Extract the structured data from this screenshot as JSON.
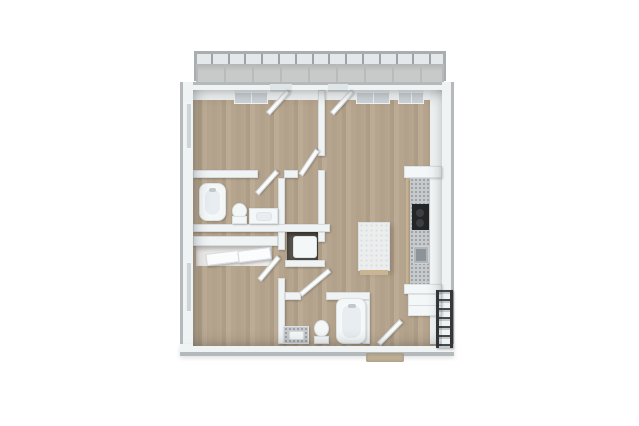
{
  "scene": {
    "type": "3d-floor-plan-render",
    "view": "top-down",
    "unit": "two-bedroom-two-bath-apartment-with-balcony",
    "visible_text": ""
  },
  "palette": {
    "bg": "#ffffff",
    "wood_a": "#b6a58e",
    "wood_b": "#ae9d86",
    "wood_c": "#bdac95",
    "wood_d": "#b3a28b",
    "balcony_tile": "#c7cac9",
    "balcony_grout": "#b7bbba",
    "railing_glass": "rgba(206,214,217,0.55)",
    "rail_bar": "#a9aeb1",
    "post": "#9da3a6",
    "wall_face": "#f0f3f4",
    "wall_edge": "#b4b9bc",
    "glass": "#cdd4d8",
    "leaf_white": "#fbfcfd",
    "fixture_white": "#f4f7f8",
    "fixture_inner": "#e7edf0",
    "granite": "#c6cacc",
    "granite_dot": "#9aa0a3",
    "wood_cabinet": "#c6b294",
    "appliance_black": "#232527",
    "burner": "#3c3f42",
    "sink_outer": "#b0b6ba",
    "sink_inner": "#8d9498",
    "rack_dark": "#35383b",
    "rack_rung": "#45494c",
    "island_top": "#eceeee",
    "island_dot": "#d9dddf",
    "island_base": "#c9b493",
    "mat": "#b8a88b",
    "niche_dark": "#57524b",
    "closet_floor": "#eceae6"
  },
  "balcony": {
    "railing_post_count": 16
  },
  "rooms": [
    {
      "id": "balcony"
    },
    {
      "id": "bedroom-1",
      "position": "top-left"
    },
    {
      "id": "living-dining",
      "position": "right"
    },
    {
      "id": "bathroom-1",
      "position": "middle-left"
    },
    {
      "id": "walk-in-closet",
      "position": "center"
    },
    {
      "id": "utility-closet",
      "position": "center"
    },
    {
      "id": "bedroom-2",
      "position": "bottom-left"
    },
    {
      "id": "bathroom-2",
      "position": "bottom-center"
    },
    {
      "id": "entry",
      "position": "bottom-right"
    }
  ],
  "fixtures": [
    "glass-railing",
    "balcony-doors",
    "bathtub-1",
    "toilet-1",
    "vanity-sink-1",
    "walk-in-closet-door",
    "water-heater",
    "sliding-closet-doors",
    "bathtub-2",
    "toilet-2",
    "vanity-sink-2",
    "kitchen-counter",
    "cooktop",
    "kitchen-sink",
    "wall-cabinets",
    "refrigerator",
    "kitchen-island",
    "entry-door",
    "doormat",
    "metal-shelf-rack",
    "windows"
  ]
}
